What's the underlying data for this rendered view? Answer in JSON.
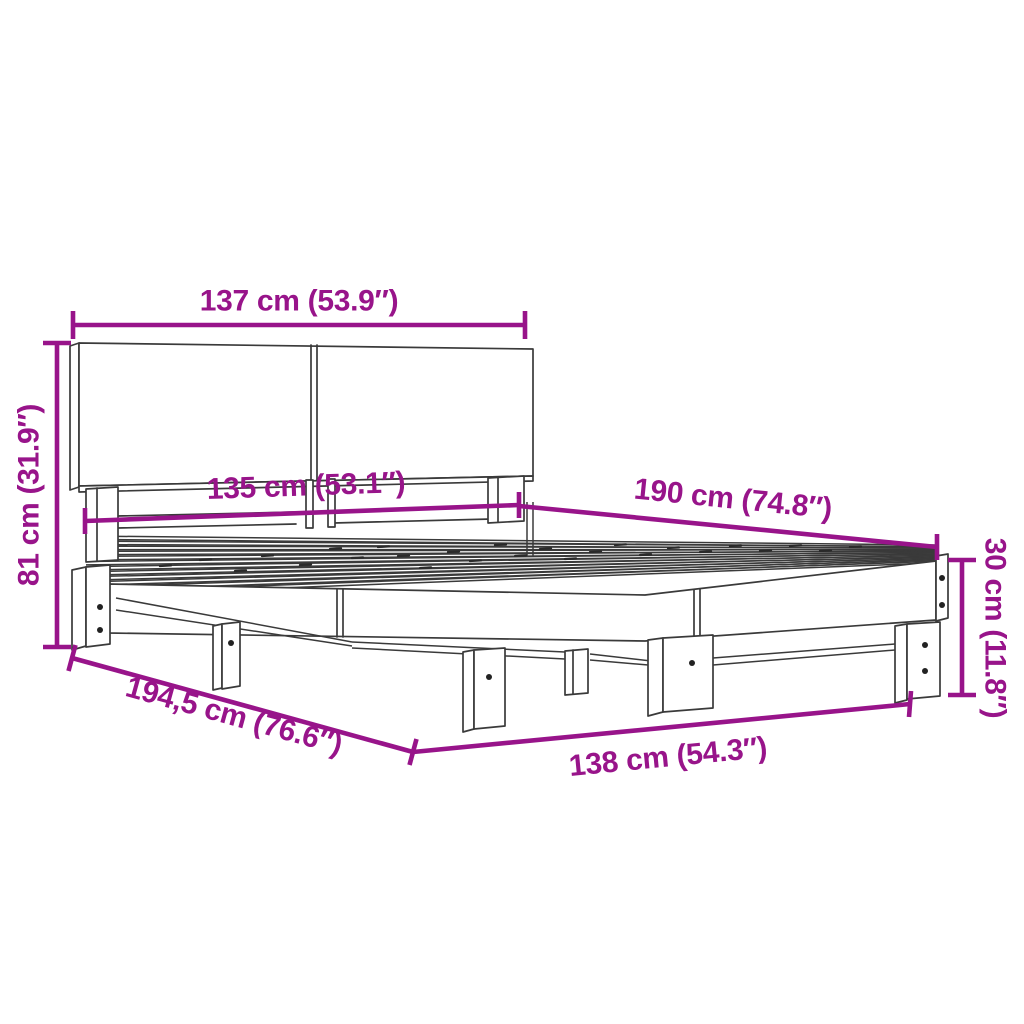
{
  "diagram": {
    "accent_color": "#98148A",
    "line_color": "#3A3A3A",
    "background_color": "#FFFFFF"
  },
  "dimensions": {
    "top_width": "137 cm (53.9″)",
    "left_height": "81 cm (31.9″)",
    "middle_width": "135 cm (53.1″)",
    "right_length": "190 cm (74.8″)",
    "right_height": "30 cm (11.8″)",
    "bottom_left_length": "194,5 cm (76.6″)",
    "bottom_width": "138 cm (54.3″)"
  }
}
